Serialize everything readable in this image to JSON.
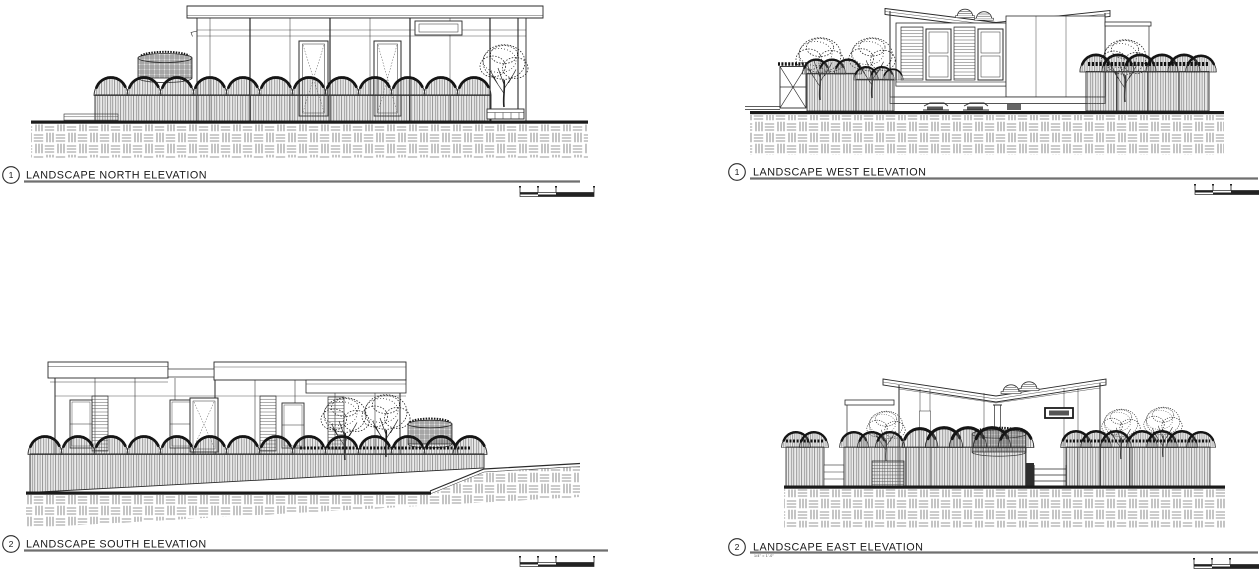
{
  "page": {
    "background": "#ffffff",
    "line_color": "#2a2a2a",
    "title_underline_color": "#6f6f6f"
  },
  "panels": [
    {
      "id": "north",
      "ref_number": "1",
      "title": "LANDSCAPE NORTH ELEVATION"
    },
    {
      "id": "west",
      "ref_number": "1",
      "title": "LANDSCAPE WEST ELEVATION"
    },
    {
      "id": "south",
      "ref_number": "2",
      "title": "LANDSCAPE SOUTH ELEVATION"
    },
    {
      "id": "east",
      "ref_number": "2",
      "title": "LANDSCAPE EAST ELEVATION",
      "scale_note": "1/4\" = 1'-0\""
    }
  ]
}
